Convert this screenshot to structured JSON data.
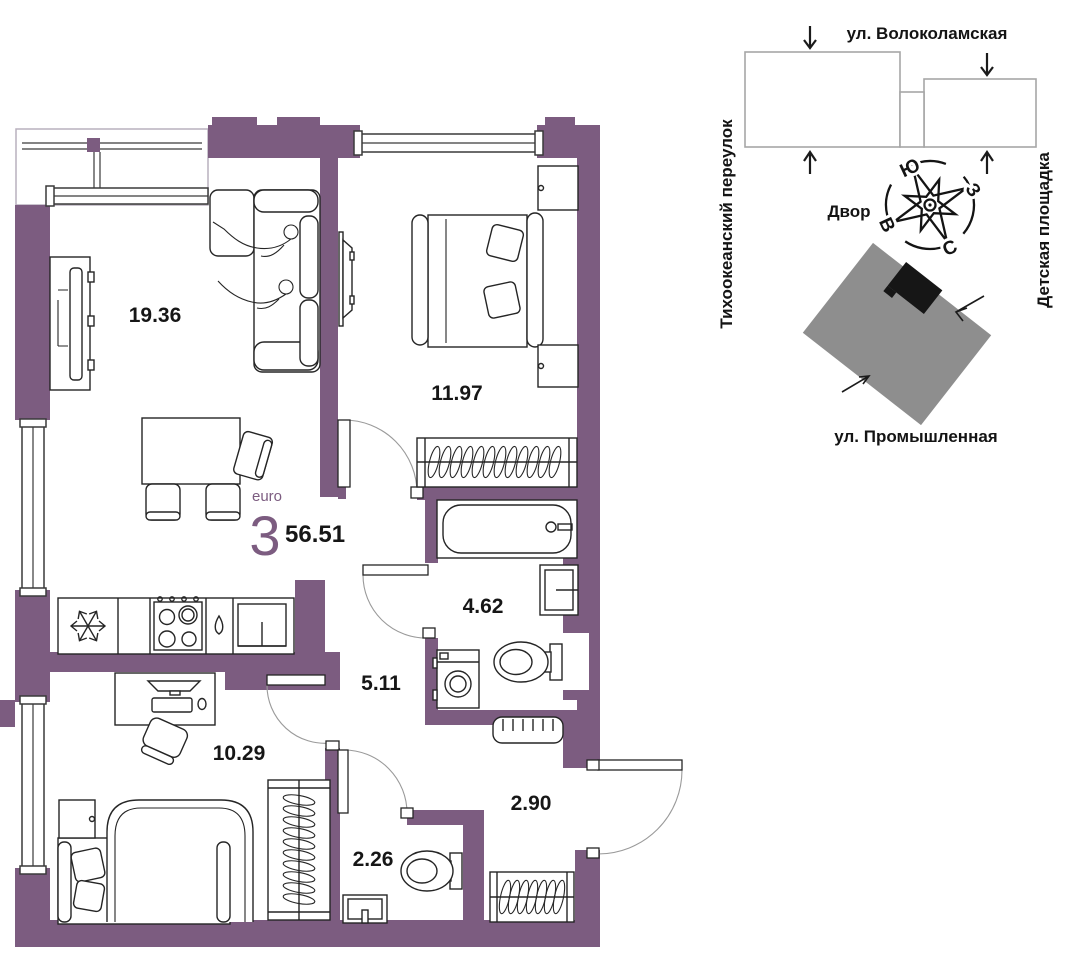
{
  "theme": {
    "wall": "#7c5c80",
    "site_gray": "#8e8e8e",
    "furniture_line": "#252525",
    "label_color": "#161616"
  },
  "plan": {
    "rooms": [
      {
        "id": "living-kitchen",
        "area": "19.36"
      },
      {
        "id": "bedroom",
        "area": "11.97"
      },
      {
        "id": "bathroom",
        "area": "4.62"
      },
      {
        "id": "hall",
        "area": "5.11"
      },
      {
        "id": "bedroom-2",
        "area": "10.29"
      },
      {
        "id": "corridor",
        "area": "2.90"
      },
      {
        "id": "wc",
        "area": "2.26"
      }
    ],
    "type_label": "euro",
    "rooms_count": "3",
    "total_area": "56.51"
  },
  "site": {
    "street_top": "ул. Волоколамская",
    "street_left": "Тихоокеанский переулок",
    "street_right": "Детская площадка",
    "yard_label": "Двор",
    "street_bottom": "ул. Промышленная",
    "compass": {
      "south": "Ю",
      "west": "З",
      "east": "В",
      "north": "С"
    }
  }
}
